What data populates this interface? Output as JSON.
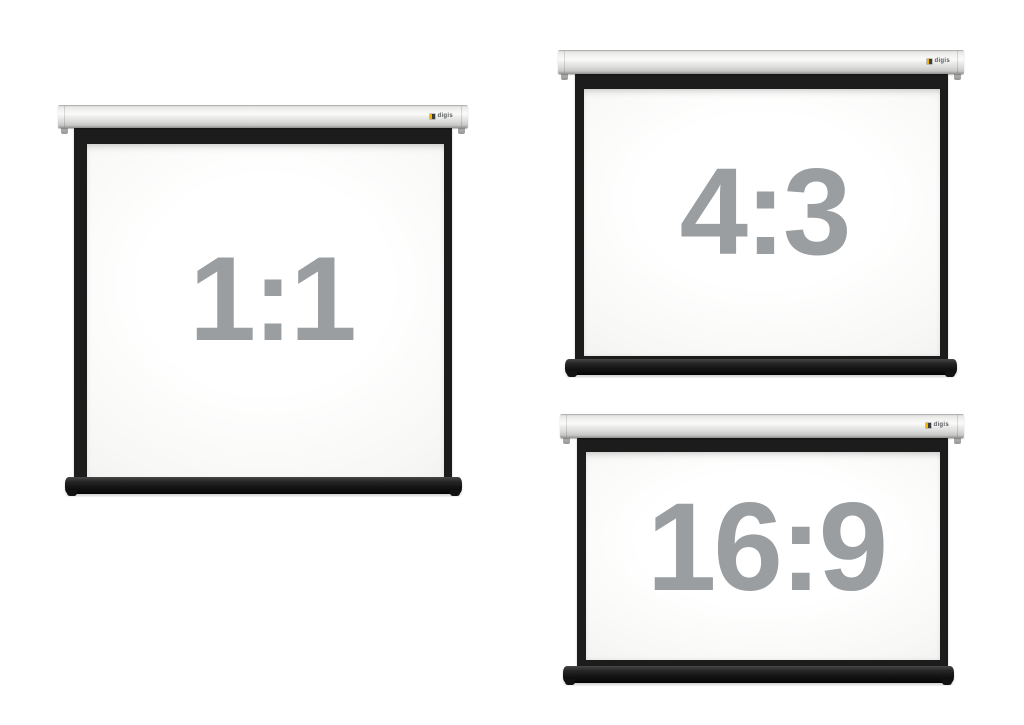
{
  "page": {
    "background_color": "#ffffff",
    "description": "Three motorized roll-down projector screens shown in different aspect ratio formats"
  },
  "brand": {
    "logo_text": "digis",
    "logo_accent_color": "#f5b301",
    "logo_text_color": "#55585c"
  },
  "colors": {
    "ratio_label_gray": "#9a9ea1",
    "frame_black": "#1c1c1c",
    "case_gray": "#e9e9e7",
    "canvas_white": "#fbfbfa",
    "weight_bar_black": "#141414"
  },
  "screens": [
    {
      "id": "square",
      "aspect_label": "1:1"
    },
    {
      "id": "standard",
      "aspect_label": "4:3"
    },
    {
      "id": "widescreen",
      "aspect_label": "16:9"
    }
  ]
}
